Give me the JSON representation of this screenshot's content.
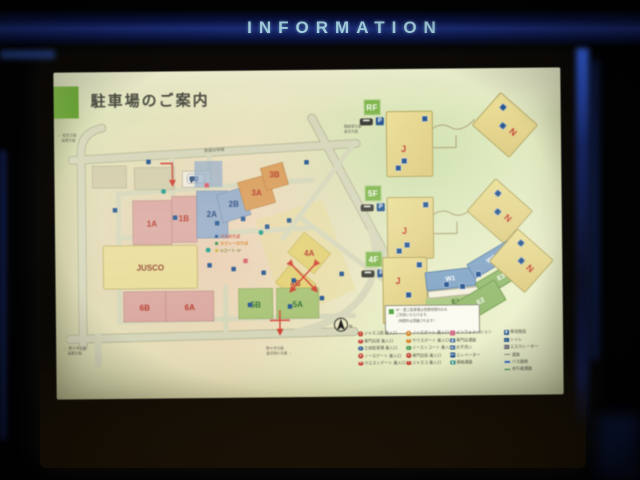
{
  "page": {
    "header_title": "INFORMATION"
  },
  "sign": {
    "title": "駐車場のご案内",
    "parking_label": "P",
    "map": {
      "zones": [
        {
          "label": "1A"
        },
        {
          "label": "1B"
        },
        {
          "label": "2A"
        },
        {
          "label": "2B"
        },
        {
          "label": "3A"
        },
        {
          "label": "3B"
        },
        {
          "label": "4A"
        },
        {
          "label": "4B"
        },
        {
          "label": "5A"
        },
        {
          "label": "5B"
        },
        {
          "label": "6A"
        },
        {
          "label": "6B"
        }
      ],
      "building": "JUSCO",
      "stores": [
        "バスのりば",
        "タクシーのりば",
        "Gコート 1F"
      ],
      "compass": "N",
      "roads": {
        "top": "県道59号線",
        "topright1": "御経塚方面",
        "topright2": "金沢方面",
        "left1": "← 松任方面",
        "left2": "　高尾方面",
        "bottomleft1": "← 野々市方面",
        "bottomleft2": "　高尾方面",
        "bottom1": "野々市方面",
        "bottom2": "金沢西IC方面 →"
      }
    },
    "floors": [
      {
        "label": "RF",
        "areas": [
          "J",
          "N"
        ]
      },
      {
        "label": "5F",
        "areas": [
          "J",
          "N"
        ]
      },
      {
        "label": "4F",
        "areas": [
          "J",
          "W1",
          "W2",
          "E1",
          "E2",
          "E3",
          "N"
        ]
      }
    ],
    "note_lines": [
      "4F・屋上駐車場は営業時間内のみ",
      "ご利用いただけます。",
      "（時間外は閉鎖されます）"
    ],
    "legend": {
      "columns": [
        {
          "items": [
            {
              "shape": "circle",
              "color": "#c0392b",
              "glyph": "J",
              "label": "ジャスコ前 乗入口"
            },
            {
              "shape": "circle",
              "color": "#c0392b",
              "glyph": "S",
              "label": "専門店前 乗入口"
            },
            {
              "shape": "circle",
              "color": "#1d4f8c",
              "glyph": "P",
              "label": "立体駐車場 乗入口"
            },
            {
              "shape": "circle",
              "color": "#c0392b",
              "glyph": "N",
              "label": "ノースゲート 乗入口"
            },
            {
              "shape": "circle",
              "color": "#c0392b",
              "glyph": "W",
              "label": "ウエストゲート 乗入口"
            }
          ]
        },
        {
          "items": [
            {
              "shape": "circle",
              "color": "#d07818",
              "glyph": "N",
              "label": "ノースポート 乗入口"
            },
            {
              "shape": "circle",
              "color": "#d07818",
              "glyph": "S",
              "label": "サウスポート 乗入口"
            },
            {
              "shape": "circle",
              "color": "#2e8b3a",
              "glyph": "E",
              "label": "イーストコート 乗入口"
            },
            {
              "shape": "circle",
              "color": "#c0392b",
              "glyph": "G",
              "label": "専門店街 乗入口"
            },
            {
              "shape": "circle",
              "color": "#c0392b",
              "glyph": "J",
              "label": "ジャスコ 乗入口"
            }
          ]
        },
        {
          "items": [
            {
              "shape": "square",
              "color": "#d06080",
              "glyph": "i",
              "label": "インフォメーション"
            },
            {
              "shape": "square",
              "color": "#1d4f8c",
              "glyph": "通",
              "label": "専門店通路"
            },
            {
              "shape": "square",
              "color": "#1d4f8c",
              "glyph": "WC",
              "label": "お手洗い"
            },
            {
              "shape": "square",
              "color": "#1d4f8c",
              "glyph": "EV",
              "label": "エレベーター"
            },
            {
              "shape": "square",
              "color": "#17807a",
              "glyph": "連",
              "label": "連絡通路"
            }
          ]
        },
        {
          "items": [
            {
              "shape": "square",
              "color": "#1d4f8c",
              "glyph": "階",
              "label": "専用階段"
            },
            {
              "shape": "square",
              "color": "#1d4f8c",
              "glyph": "ト",
              "label": "トイレ"
            },
            {
              "shape": "square",
              "color": "#444455",
              "glyph": "ES",
              "label": "エスカレーター"
            },
            {
              "shape": "line",
              "color": "#8a8a7a",
              "glyph": "",
              "label": "道路"
            },
            {
              "shape": "line",
              "color": "#3a6ad0",
              "glyph": "",
              "label": "バス路線"
            },
            {
              "shape": "line",
              "color": "#2e8b3a",
              "glyph": "",
              "label": "歩行者通路"
            }
          ]
        }
      ]
    }
  }
}
